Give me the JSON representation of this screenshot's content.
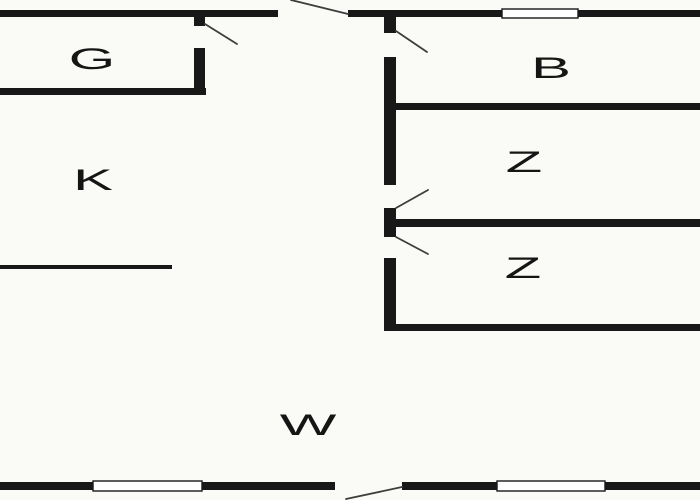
{
  "floorplan": {
    "title": "apartment-floor-plan",
    "colors": {
      "background": "#fafaf6",
      "wall": "#181818",
      "door_swing": "#3d3d3d",
      "window_fill": "#ffffff",
      "label": "#151515"
    },
    "label_font_size": 30,
    "label_scale_x": 2.0,
    "rooms": [
      {
        "name": "room-label-g",
        "label": "G",
        "x": 92,
        "y": 58
      },
      {
        "name": "room-label-k",
        "label": "K",
        "x": 93,
        "y": 179
      },
      {
        "name": "room-label-b",
        "label": "B",
        "x": 551,
        "y": 67
      },
      {
        "name": "room-label-z1",
        "label": "Z",
        "x": 524,
        "y": 161
      },
      {
        "name": "room-label-z2",
        "label": "Z",
        "x": 523,
        "y": 267
      },
      {
        "name": "room-label-w",
        "label": "W",
        "x": 308,
        "y": 424
      }
    ],
    "walls": [
      {
        "name": "top-wall-left",
        "x": 0,
        "y": 10,
        "w": 278,
        "h": 7
      },
      {
        "name": "top-wall-middle",
        "x": 348,
        "y": 10,
        "w": 154,
        "h": 7
      },
      {
        "name": "top-wall-right",
        "x": 578,
        "y": 10,
        "w": 122,
        "h": 7
      },
      {
        "name": "g-room-bottom-wall",
        "x": 0,
        "y": 88,
        "w": 206,
        "h": 7
      },
      {
        "name": "g-room-right-wall-stub",
        "x": 194,
        "y": 17,
        "w": 11,
        "h": 9
      },
      {
        "name": "g-room-right-wall",
        "x": 194,
        "y": 48,
        "w": 11,
        "h": 47
      },
      {
        "name": "hall-wall-stub",
        "x": 384,
        "y": 17,
        "w": 12,
        "h": 16
      },
      {
        "name": "hall-wall-upper",
        "x": 384,
        "y": 57,
        "w": 12,
        "h": 128
      },
      {
        "name": "hall-wall-between-doors",
        "x": 384,
        "y": 208,
        "w": 12,
        "h": 29
      },
      {
        "name": "hall-wall-lower",
        "x": 384,
        "y": 258,
        "w": 12,
        "h": 72
      },
      {
        "name": "b-room-bottom-wall",
        "x": 390,
        "y": 103,
        "w": 310,
        "h": 7
      },
      {
        "name": "z1-room-bottom-wall",
        "x": 390,
        "y": 219,
        "w": 310,
        "h": 8
      },
      {
        "name": "z2-room-bottom-wall",
        "x": 384,
        "y": 324,
        "w": 316,
        "h": 7
      },
      {
        "name": "k-room-counter-line",
        "x": 0,
        "y": 265,
        "w": 172,
        "h": 4
      },
      {
        "name": "bottom-wall-far-left",
        "x": 0,
        "y": 482,
        "w": 93,
        "h": 8
      },
      {
        "name": "bottom-wall-center-left",
        "x": 202,
        "y": 482,
        "w": 133,
        "h": 8
      },
      {
        "name": "bottom-wall-center-right",
        "x": 402,
        "y": 482,
        "w": 95,
        "h": 8
      },
      {
        "name": "bottom-wall-far-right",
        "x": 605,
        "y": 482,
        "w": 95,
        "h": 8
      }
    ],
    "windows": [
      {
        "name": "window-top",
        "x": 502,
        "y": 9,
        "w": 76,
        "h": 9
      },
      {
        "name": "window-bottom-left",
        "x": 93,
        "y": 481,
        "w": 109,
        "h": 10
      },
      {
        "name": "window-bottom-right",
        "x": 497,
        "y": 481,
        "w": 108,
        "h": 10
      }
    ],
    "door_swings": [
      {
        "name": "g-room-door-swing",
        "x1": 205,
        "y1": 24,
        "x2": 237,
        "y2": 44
      },
      {
        "name": "entrance-door-swing",
        "x1": 291,
        "y1": 0,
        "x2": 348,
        "y2": 14
      },
      {
        "name": "b-room-door-swing",
        "x1": 396,
        "y1": 31,
        "x2": 427,
        "y2": 52
      },
      {
        "name": "z1-room-door-swing",
        "x1": 396,
        "y1": 208,
        "x2": 428,
        "y2": 190
      },
      {
        "name": "z2-room-door-swing",
        "x1": 396,
        "y1": 237,
        "x2": 428,
        "y2": 254
      },
      {
        "name": "w-room-door-swing",
        "x1": 402,
        "y1": 487,
        "x2": 346,
        "y2": 499
      }
    ]
  }
}
